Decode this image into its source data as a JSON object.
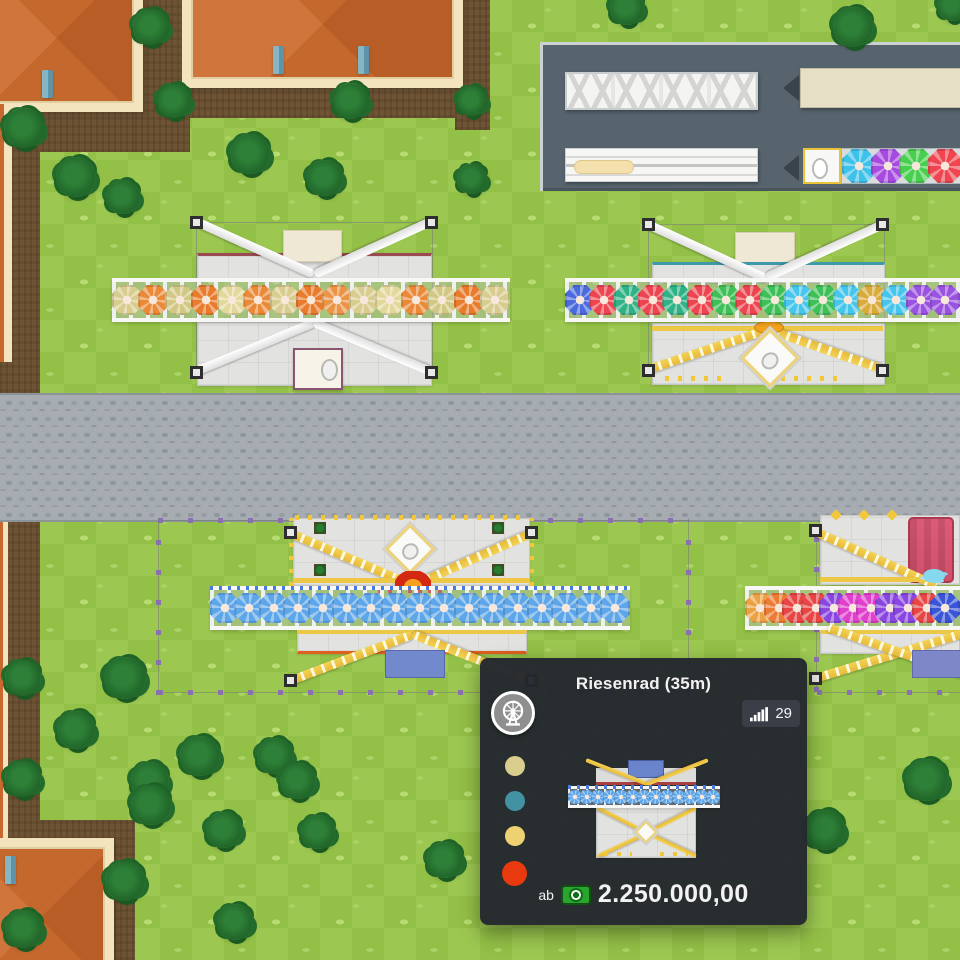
{
  "game": {
    "tooltip": {
      "title": "Riesenrad (35m)",
      "category_icon": "ferris-wheel-icon",
      "stat_badge": {
        "icon": "signal-bars-icon",
        "value": "29"
      },
      "color_options": [
        "#d9ce8e",
        "#4292a4",
        "#eed272",
        "#e83a0e"
      ],
      "price": {
        "prefix": "ab",
        "icon": "money-icon",
        "amount": "2.250.000,00"
      }
    },
    "rides": {
      "orange": {
        "gondolas": [
          "#d8cc8e",
          "#ea8a38",
          "#d2c884",
          "#e87c2c",
          "#e2d89c",
          "#ea8a38",
          "#d8cc8e",
          "#e87c2c",
          "#ea9446",
          "#d8cc8e",
          "#e2d89c",
          "#ea8a38",
          "#d2c884",
          "#e87c2c",
          "#d8cc8e"
        ]
      },
      "multicolor": {
        "gondolas": [
          "#4a6ade",
          "#ec4550",
          "#2fb285",
          "#ec4550",
          "#2fb285",
          "#ec4550",
          "#3ec056",
          "#ec4550",
          "#3ec056",
          "#46c6ec",
          "#3ec056",
          "#46c6ec",
          "#d8ab3a",
          "#46c6ec",
          "#9a52e0",
          "#9a52e0"
        ]
      },
      "blue": {
        "gondolas": [
          "#5ea6ea",
          "#5ea6ea",
          "#5ea6ea",
          "#5ea6ea",
          "#5ea6ea",
          "#5ea6ea",
          "#5ea6ea",
          "#5ea6ea",
          "#5ea6ea",
          "#5ea6ea",
          "#5ea6ea",
          "#5ea6ea",
          "#5ea6ea",
          "#5ea6ea",
          "#5ea6ea",
          "#5ea6ea",
          "#5ea6ea"
        ]
      },
      "rainbow": {
        "gondolas": [
          "#eca244",
          "#ec7c34",
          "#e84545",
          "#e84545",
          "#8a46e0",
          "#e040cc",
          "#e040cc",
          "#8a46e0",
          "#8a46e0",
          "#e84545",
          "#3a55d8"
        ]
      },
      "preview": {
        "gondolas": [
          "#5ea6ea",
          "#5ea6ea",
          "#5ea6ea",
          "#5ea6ea",
          "#5ea6ea",
          "#5ea6ea",
          "#5ea6ea",
          "#5ea6ea",
          "#5ea6ea",
          "#5ea6ea",
          "#5ea6ea",
          "#5ea6ea",
          "#5ea6ea"
        ]
      }
    },
    "trucks": {
      "gondola_truck": {
        "gondolas": [
          "#3ec1ea",
          "#a64ae0",
          "#49cf4f",
          "#ef4550"
        ]
      }
    },
    "palette": {
      "grass_light": "#9cc851",
      "grass_dark": "#93c047",
      "dirt": "#6e5334",
      "road": "#a6acb1",
      "asphalt": "#57636d",
      "roof": "#c4682e",
      "roof_trim": "#f4e4bd",
      "tooltip_bg": "#24282e",
      "badge_bg": "#3a3f47",
      "money_green": "#2ca52e",
      "boundary_purple": "#8a6fb2",
      "beam_yellow": "#edc446",
      "beam_white": "#f2f2f0"
    }
  }
}
